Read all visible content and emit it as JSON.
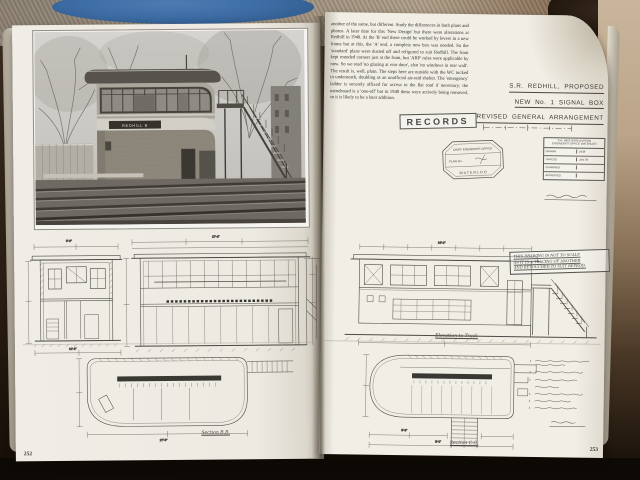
{
  "colors": {
    "carpet": "#9a8d7b",
    "blue_fabric": "#3e6da6",
    "tan_cloth": "#c7b29a",
    "dark_surface": "#0d0a06",
    "page": "#f1eee6",
    "ink": "#3d3b37",
    "photo_sky": "#d3d1cd"
  },
  "book": {
    "left_page": {
      "page_number": "252",
      "photo": {
        "description": "black and white photograph of Redhill brick signal box with wrap-around window band, rounded corner, nameboard and external staircase beside railway tracks",
        "nameboard_text": "REDHILL B"
      },
      "labels": {
        "plan_label": "Section B.B."
      },
      "dims": [
        "9'-6\"",
        "12'-6\"",
        "27'-6\"",
        "34'-0\"",
        "8'-6\"",
        "5'-0\""
      ]
    },
    "right_page": {
      "page_number": "253",
      "body_text": "another of the same, but different. Study the differences in both plans and photos. A later date for this 'New Design' but there were alterations at Redhill in 1940. At the 'B' end these could be worked by levers in a new frame but at this, the 'A' end, a complete new box was needed. So the 'standard' plans were dusted off and refigured to suit Redhill. The front kept rounded corners just at the front, but 'ARP' rules were applicable by now. So we read 'no glazing at rear door', also 'no windows in rear wall'. The result is, well, plain. The steps here are outside with the WC tucked in underneath, doubling as an unofficial air-raid shelter. The 'emergency' ladder is securely affixed for access to the flat roof if necessary; the nameboard is a 'one-off' but in 1940 these were actively being removed, so it is likely to be a later addition.",
      "title_line1": "S.R. REDHILL, PROPOSED",
      "title_line2": "NEW No. 1 SIGNAL BOX",
      "title_line3": "REVISED GENERAL ARRANGEMENT",
      "records_stamp": "RECORDS",
      "office_stamp": {
        "line1": "CHIEF ENGINEERS OFFICE",
        "line2": "PLAN No.",
        "line3": "WATERLOO"
      },
      "title_block": {
        "header": "S.R. WESTERN DIVISION",
        "subheader": "ENGINEER'S OFFICE WATERLOO",
        "rows": [
          {
            "label": "DRAWN",
            "value": "1938"
          },
          {
            "label": "TRACED",
            "value": "JAN 39"
          },
          {
            "label": "EXAMINED",
            "value": ""
          },
          {
            "label": "APPROVED",
            "value": ""
          }
        ]
      },
      "note_box": {
        "line1": "THIS DRAWING IS NOT TO SCALE",
        "line2": "AS IT IS A TRACING OF ANOTHER",
        "line3": "AND RETOUCHED TO SUIT REPROD."
      },
      "labels": {
        "elevation_label": "Elevation to Track",
        "section_label": "Section C.C."
      },
      "handwritten_notes_count": "7"
    }
  }
}
